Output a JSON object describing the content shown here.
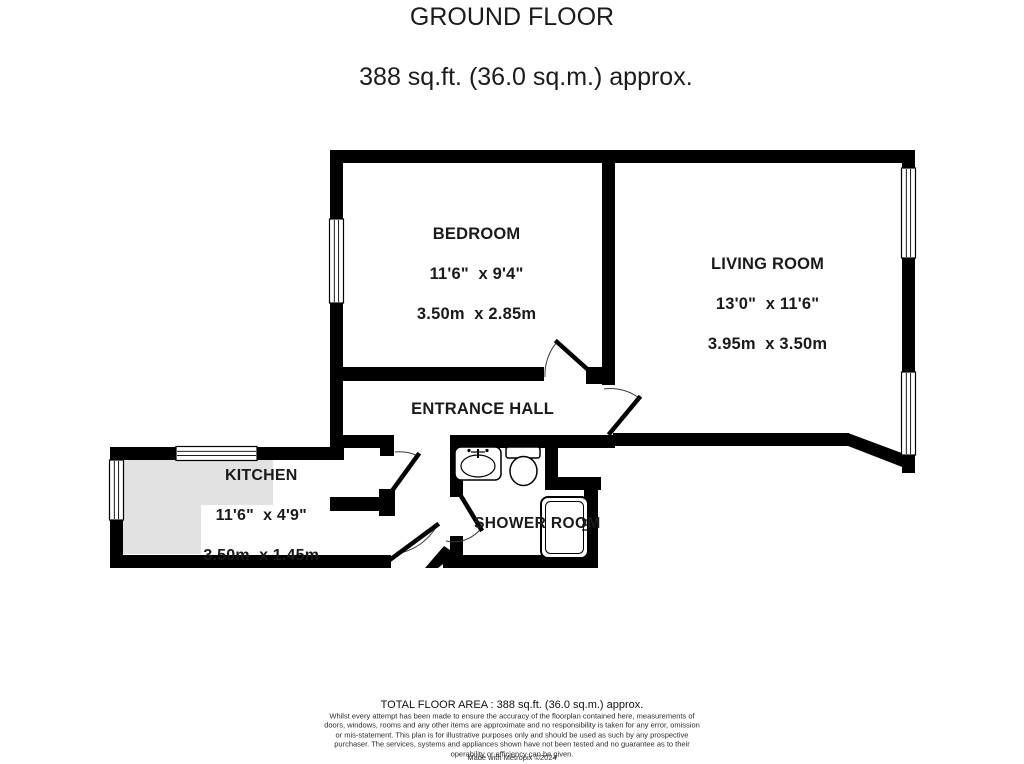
{
  "title": {
    "line1": "GROUND FLOOR",
    "line2": "388 sq.ft. (36.0 sq.m.) approx."
  },
  "rooms": {
    "bedroom": {
      "name": "BEDROOM",
      "imperial": "11'6\"  x 9'4\"",
      "metric": "3.50m  x 2.85m"
    },
    "living_room": {
      "name": "LIVING ROOM",
      "imperial": "13'0\"  x 11'6\"",
      "metric": "3.95m  x 3.50m"
    },
    "entrance_hall": {
      "name": "ENTRANCE HALL"
    },
    "kitchen": {
      "name": "KITCHEN",
      "imperial": "11'6\"  x 4'9\"",
      "metric": "3.50m  x 1.45m"
    },
    "shower_room": {
      "name": "SHOWER ROOM"
    }
  },
  "fixtures": [
    "sink-icon",
    "toilet-icon",
    "shower-icon",
    "window-icon",
    "door-swing-icon"
  ],
  "footer": {
    "total_area": "TOTAL FLOOR AREA : 388 sq.ft. (36.0 sq.m.) approx.",
    "disclaimer": "Whilst every attempt has been made to ensure the accuracy of the floorplan contained here, measurements of doors, windows, rooms and any other items are approximate and no responsibility is taken for any error, omission or mis-statement. This plan is for illustrative purposes only and should be used as such by any prospective purchaser. The services, systems and appliances shown have not been tested and no guarantee as to their operability or efficiency can be given.",
    "credit": "Made with Metropix ©2024"
  },
  "colors": {
    "wall": "#000000",
    "counter": "#e2e2e2",
    "text": "#1a1a1a",
    "background": "#ffffff"
  }
}
